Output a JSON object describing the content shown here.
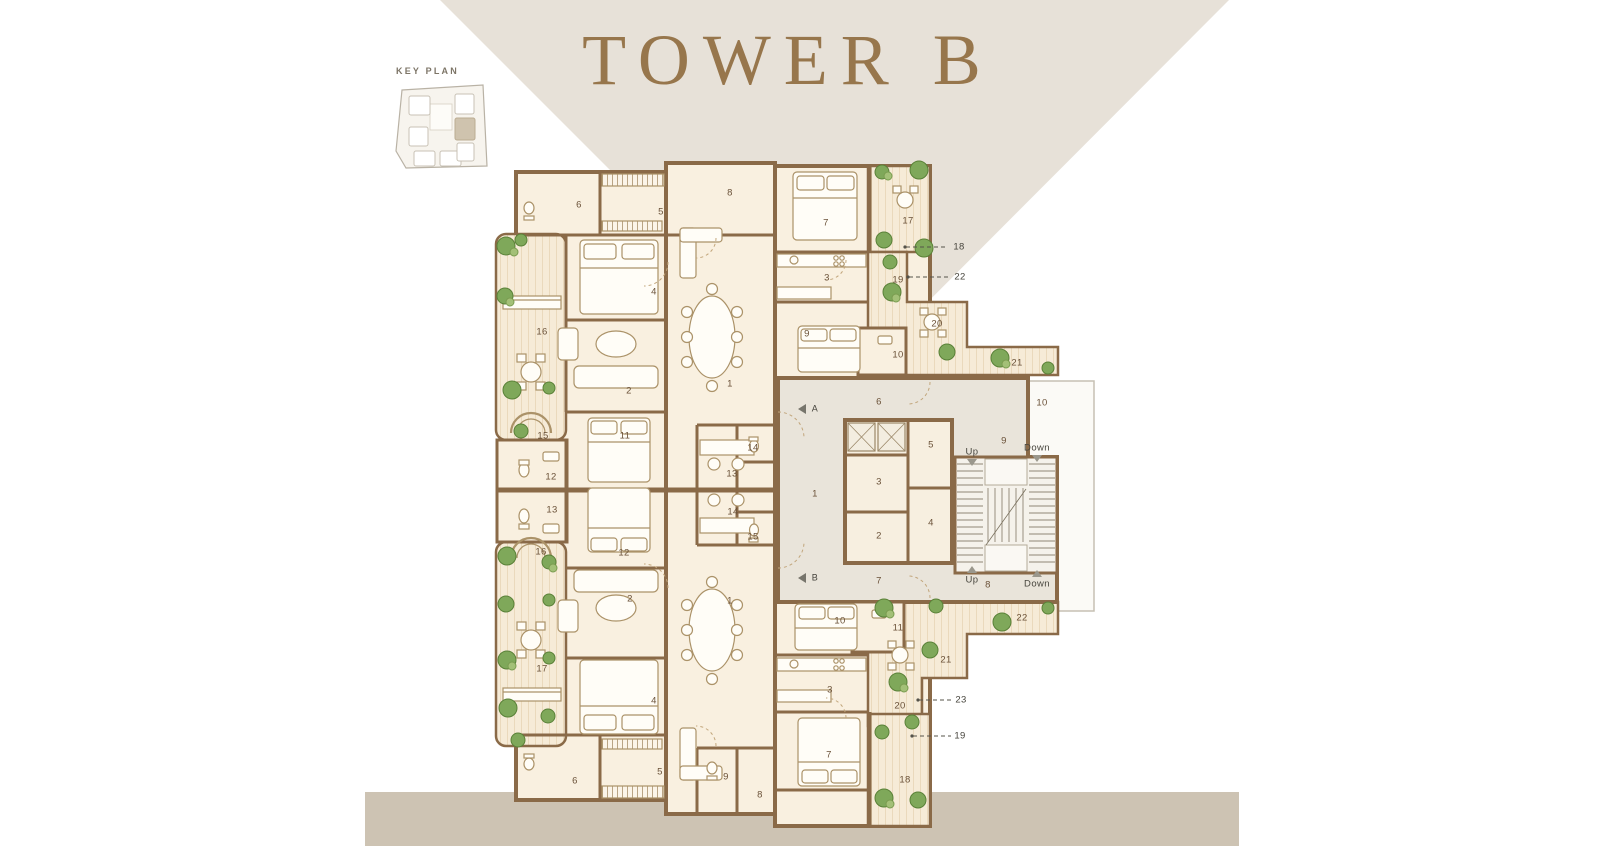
{
  "title": "TOWER B",
  "key_plan": {
    "label": "KEY PLAN"
  },
  "colors": {
    "background": "#ffffff",
    "wedge_beige": "#e7e1d8",
    "bottom_strip": "#cdc3b3",
    "title_brown": "#97764c",
    "wall_brown": "#8a6a48",
    "room_cream": "#f9f0e0",
    "terrace_deck": "#f6ebd7",
    "core_floor": "#e9e4da",
    "plant_green": "#7fa85a",
    "keyplan_highlight": "#cfc3ae",
    "label_brown": "#6a5138"
  },
  "plan": {
    "labels": [
      {
        "t": "6",
        "x": 579,
        "y": 205,
        "k": "room"
      },
      {
        "t": "5",
        "x": 661,
        "y": 212,
        "k": "room"
      },
      {
        "t": "8",
        "x": 730,
        "y": 193,
        "k": "room"
      },
      {
        "t": "7",
        "x": 826,
        "y": 223,
        "k": "room"
      },
      {
        "t": "17",
        "x": 908,
        "y": 221,
        "k": "room"
      },
      {
        "t": "4",
        "x": 654,
        "y": 292,
        "k": "room"
      },
      {
        "t": "3",
        "x": 827,
        "y": 278,
        "k": "room"
      },
      {
        "t": "19",
        "x": 898,
        "y": 280,
        "k": "room"
      },
      {
        "t": "16",
        "x": 542,
        "y": 332,
        "k": "room"
      },
      {
        "t": "9",
        "x": 807,
        "y": 334,
        "k": "room"
      },
      {
        "t": "10",
        "x": 898,
        "y": 355,
        "k": "room"
      },
      {
        "t": "20",
        "x": 937,
        "y": 324,
        "k": "room"
      },
      {
        "t": "21",
        "x": 1017,
        "y": 363,
        "k": "room"
      },
      {
        "t": "2",
        "x": 629,
        "y": 391,
        "k": "room"
      },
      {
        "t": "1",
        "x": 730,
        "y": 384,
        "k": "room"
      },
      {
        "t": "15",
        "x": 543,
        "y": 436,
        "k": "room"
      },
      {
        "t": "11",
        "x": 625,
        "y": 436,
        "k": "room"
      },
      {
        "t": "12",
        "x": 551,
        "y": 477,
        "k": "room"
      },
      {
        "t": "13",
        "x": 732,
        "y": 474,
        "k": "room"
      },
      {
        "t": "14",
        "x": 753,
        "y": 448,
        "k": "room"
      },
      {
        "t": "13",
        "x": 552,
        "y": 510,
        "k": "room"
      },
      {
        "t": "14",
        "x": 733,
        "y": 512,
        "k": "room"
      },
      {
        "t": "15",
        "x": 753,
        "y": 537,
        "k": "room"
      },
      {
        "t": "16",
        "x": 541,
        "y": 552,
        "k": "room"
      },
      {
        "t": "12",
        "x": 624,
        "y": 553,
        "k": "room"
      },
      {
        "t": "6",
        "x": 879,
        "y": 402,
        "k": "room"
      },
      {
        "t": "10",
        "x": 1042,
        "y": 403,
        "k": "room"
      },
      {
        "t": "9",
        "x": 1004,
        "y": 441,
        "k": "room"
      },
      {
        "t": "5",
        "x": 931,
        "y": 445,
        "k": "room"
      },
      {
        "t": "3",
        "x": 879,
        "y": 482,
        "k": "room"
      },
      {
        "t": "4",
        "x": 931,
        "y": 523,
        "k": "room"
      },
      {
        "t": "2",
        "x": 879,
        "y": 536,
        "k": "room"
      },
      {
        "t": "1",
        "x": 815,
        "y": 494,
        "k": "room"
      },
      {
        "t": "7",
        "x": 879,
        "y": 581,
        "k": "room"
      },
      {
        "t": "8",
        "x": 988,
        "y": 585,
        "k": "room"
      },
      {
        "t": "2",
        "x": 630,
        "y": 599,
        "k": "room"
      },
      {
        "t": "1",
        "x": 730,
        "y": 601,
        "k": "room"
      },
      {
        "t": "17",
        "x": 542,
        "y": 669,
        "k": "room"
      },
      {
        "t": "4",
        "x": 654,
        "y": 701,
        "k": "room"
      },
      {
        "t": "5",
        "x": 660,
        "y": 772,
        "k": "room"
      },
      {
        "t": "6",
        "x": 575,
        "y": 781,
        "k": "room"
      },
      {
        "t": "9",
        "x": 726,
        "y": 777,
        "k": "room"
      },
      {
        "t": "8",
        "x": 760,
        "y": 795,
        "k": "room"
      },
      {
        "t": "10",
        "x": 840,
        "y": 621,
        "k": "room"
      },
      {
        "t": "11",
        "x": 898,
        "y": 628,
        "k": "room"
      },
      {
        "t": "22",
        "x": 1022,
        "y": 618,
        "k": "room"
      },
      {
        "t": "21",
        "x": 946,
        "y": 660,
        "k": "room"
      },
      {
        "t": "3",
        "x": 830,
        "y": 690,
        "k": "room"
      },
      {
        "t": "20",
        "x": 900,
        "y": 706,
        "k": "room"
      },
      {
        "t": "7",
        "x": 829,
        "y": 755,
        "k": "room"
      },
      {
        "t": "18",
        "x": 905,
        "y": 780,
        "k": "room"
      },
      {
        "t": "Up",
        "x": 972,
        "y": 452,
        "k": "nav"
      },
      {
        "t": "Down",
        "x": 1037,
        "y": 448,
        "k": "nav"
      },
      {
        "t": "Up",
        "x": 972,
        "y": 580,
        "k": "nav"
      },
      {
        "t": "Down",
        "x": 1037,
        "y": 584,
        "k": "nav"
      },
      {
        "t": "A",
        "x": 815,
        "y": 409,
        "k": "marker"
      },
      {
        "t": "B",
        "x": 815,
        "y": 578,
        "k": "marker"
      },
      {
        "t": "18",
        "x": 959,
        "y": 247,
        "k": "leader"
      },
      {
        "t": "22",
        "x": 960,
        "y": 277,
        "k": "leader"
      },
      {
        "t": "23",
        "x": 961,
        "y": 700,
        "k": "leader"
      },
      {
        "t": "19",
        "x": 960,
        "y": 736,
        "k": "leader"
      }
    ]
  }
}
